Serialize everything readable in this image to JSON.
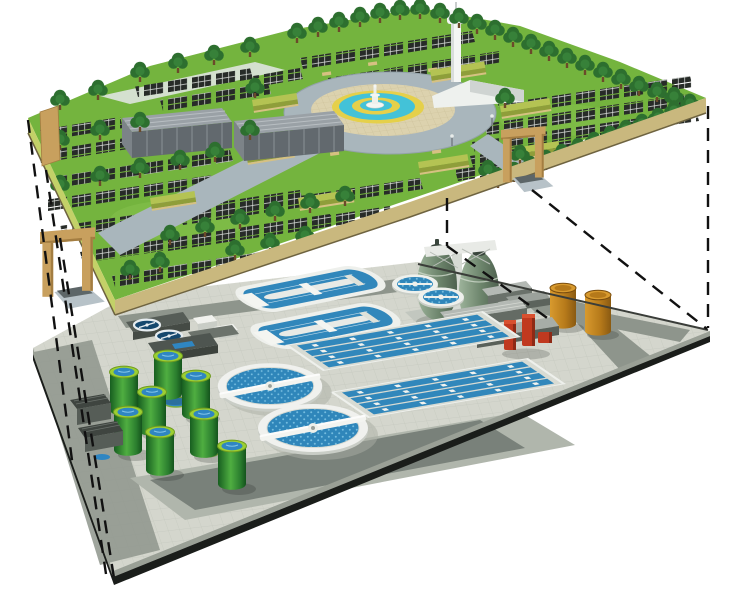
{
  "scene": {
    "type": "isometric-cutaway-illustration",
    "colors": {
      "background": "#ffffff"
    },
    "projection": {
      "dashed_lines": 7,
      "color": "#111111",
      "dash_pattern": "13 9"
    },
    "upper_level": {
      "name": "ground-level-solar-park",
      "features": {
        "solar_panel_rows": 20,
        "trees": 64,
        "hedge_walls": 8,
        "warehouse_buildings": 2,
        "entrance_gates": 2,
        "observation_tower": 1,
        "fountain_plaza": 1,
        "plaza_lamps": 4,
        "plaza_benches": 5
      },
      "colors": {
        "grass": "#74b43e",
        "grass_light": "#86c24d",
        "back_fringe": "#e9ece9",
        "pale_pad": "#dfe4df",
        "edge_face_front": "#c9b87e",
        "edge_face_left": "#c3d168",
        "plaza": "#a9b6bc",
        "pavement_ring": "#dcd2ae",
        "fountain_ring_yellow": "#e5d04a",
        "fountain_water_teal": "#43c2d8",
        "fountain_white": "#f4f6f3",
        "tree_green": "#2d6f2f",
        "tree_trunk": "#6b4a2a",
        "solar_panel": "#272b28",
        "solar_panel_grid": "#dfe3df",
        "hedge_top": "#b4c353",
        "hedge_side": "#8f9e3a",
        "hedge_base": "#d6c182",
        "gate_wood": "#c8a05e",
        "gate_wood_dark": "#a37d41",
        "warehouse_roof": "#9aa1a6",
        "warehouse_front": "#62696e",
        "tower_white": "#f4f6f4"
      }
    },
    "lower_level": {
      "name": "underground-wastewater-treatment-plant",
      "features": {
        "egg_digesters": 2,
        "amber_storage_tanks": 2,
        "oxidation_ditches": 2,
        "round_process_tanks": 2,
        "aeration_basins": 2,
        "channels_per_basin": 4,
        "circular_clarifiers": 2,
        "green_sludge_tanks": 8,
        "navy_mixing_tanks": 2,
        "service_buildings": 7,
        "red_pump_unit": 1,
        "blue_ground_pads": 2
      },
      "colors": {
        "floor_tile": "#d4d6cd",
        "tile_grid": "#c5c8be",
        "road": "#8e958c",
        "road_dark": "#79817a",
        "apron": "#b0b6ac",
        "dark_pad": "#6c736c",
        "edge_band_light": "#9aa096",
        "edge_band_dark": "#1a1d1a",
        "water_blue": "#2f86ba",
        "water_dot": "#74bcdf",
        "basin_water": "#3187bb",
        "tank_wall_white": "#f0f1ee",
        "tank_wall_shade": "#c9cdc6",
        "digester_green": "#7e987f",
        "digester_cap": "#39453c",
        "amber_tank": "#c08020",
        "red_unit": "#c0391f",
        "red_unit_dark": "#8e2a16",
        "green_tank_dark": "#175e20",
        "green_tank_light": "#4fae41",
        "green_tank_rim": "#9bcf32",
        "tank_water": "#2f86c2",
        "navy_tank": "#15486e",
        "building_gray": "#565d57"
      }
    }
  }
}
